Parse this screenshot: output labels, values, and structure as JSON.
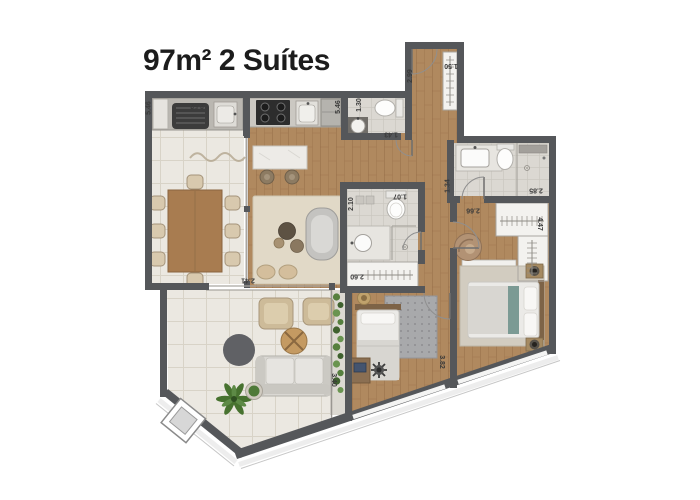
{
  "title": "97m² 2 Suítes",
  "dimensions": {
    "terrace_left": "5.46",
    "grill_counter": "2.52",
    "kitchen_right": "5.46",
    "lavabo_width": "1.30",
    "lavabo_length": "1.43",
    "entry_hall": "2.99",
    "entry_closet": "1.50",
    "bath1_depth": "2.10",
    "bath1_width": "1.07",
    "closet1_width": "2.60",
    "bath2_left": "1.34",
    "bath2_width": "2.85",
    "suite2_entry": "2.66",
    "closet2_height": "4.47",
    "suite1_depth": "3.82",
    "living_door": "2.41",
    "living_right": "3.40"
  },
  "colors": {
    "wall": "#55575a",
    "wood_floor": "#b0895f",
    "tile_floor": "#ebe8e1",
    "bath_floor": "#dbd8d2",
    "rug_beige": "#e1d9c7",
    "plant_green": "#567f3e",
    "title_text": "#1c1c1c",
    "dimension_text": "#3a3a3a"
  }
}
